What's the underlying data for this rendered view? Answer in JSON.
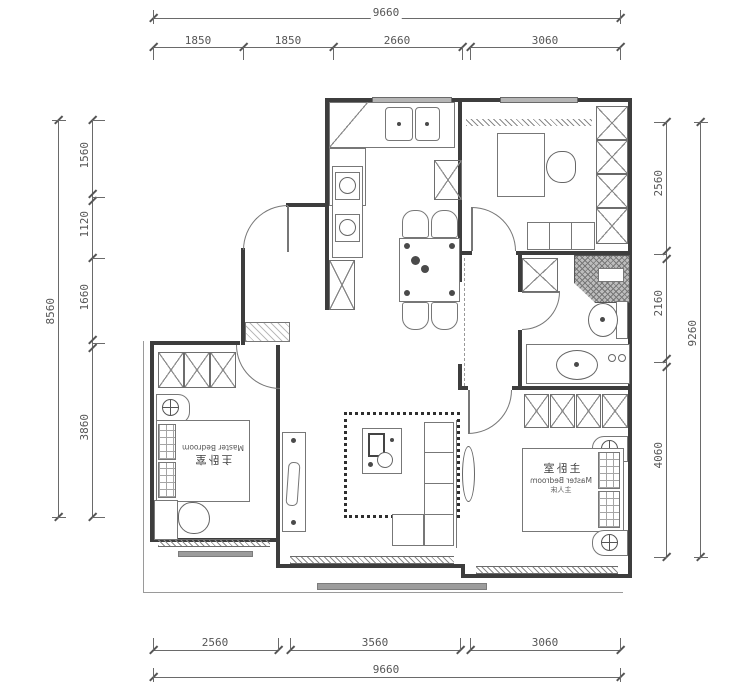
{
  "drawing_title": "apartment floor plan",
  "dimensions": {
    "top": {
      "overall": "9660",
      "segments": [
        "1850",
        "1850",
        "2660",
        "3060"
      ]
    },
    "bottom": {
      "overall": "9660",
      "segments": [
        "2560",
        "3560",
        "3060"
      ]
    },
    "left": {
      "overall": "8560",
      "segments": [
        "1560",
        "1120",
        "1660",
        "3860"
      ]
    },
    "right": {
      "overall": "9260",
      "segments": [
        "2560",
        "2160",
        "4060"
      ]
    }
  },
  "rooms": {
    "bedroom_left": {
      "name_cn": "主卧室",
      "name_en": "Master Bedroom"
    },
    "bedroom_right": {
      "name_cn": "主卧室",
      "name_en": "Master Bedroom",
      "bed": "主人床"
    }
  },
  "colors": {
    "wall": "#3d3d3d",
    "furniture_line": "#777777",
    "dimension_text": "#555555",
    "window_fill": "#b5b5b5",
    "sill_fill": "#9c9c9c"
  }
}
